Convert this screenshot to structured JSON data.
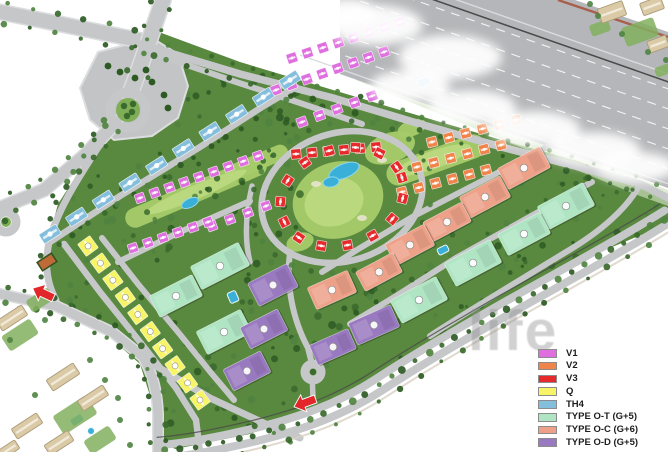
{
  "legend": {
    "items": [
      {
        "label": "V1",
        "color": "#df6fdf"
      },
      {
        "label": "V2",
        "color": "#f0854c"
      },
      {
        "label": "V3",
        "color": "#e62a2c"
      },
      {
        "label": "Q",
        "color": "#f8f468"
      },
      {
        "label": "TH4",
        "color": "#84bedd"
      },
      {
        "label": "TYPE O-T (G+5)",
        "color": "#b0e5c4"
      },
      {
        "label": "TYPE O-C (G+6)",
        "color": "#eda189"
      },
      {
        "label": "TYPE O-D (G+5)",
        "color": "#9979c0"
      }
    ]
  },
  "watermark": {
    "text": "life"
  },
  "map": {
    "colors": {
      "V1": "#df6fdf",
      "V2": "#f0854c",
      "V3": "#e62a2c",
      "Q": "#f8f468",
      "TH4": "#84bedd",
      "OT": "#b0e5c4",
      "OC": "#eda189",
      "OD": "#9979c0",
      "site": "#59883f",
      "golf": "#a6cb69",
      "golfLight": "#bdd97f",
      "sand": "#e8e4cf",
      "road": "#c6c7c9",
      "casing": "#dcdddf",
      "highway": "#b5b6b9",
      "junction": "#c3c4c6",
      "tree1": "#3a6a2d",
      "tree2": "#4f8340",
      "tree3": "#2d5a23",
      "water": "#3ab0d8",
      "waterEdge": "#8fd6ea",
      "beige": "#dbcaa6",
      "beigeEdge": "#ab9a77",
      "lawn": "#83b05e",
      "court": "#c06a38",
      "courtEdge": "#33541f",
      "arrow": "#e2262a",
      "rail": "#4a4a4a",
      "redpath": "#a75f4b",
      "badgeRing": "#8f8f8f",
      "island": "#7fae57"
    },
    "site": "148,28 240,62 333,90 420,116 505,141 575,160 640,186 668,202 668,224 600,252 520,295 430,348 340,400 250,434 175,449 160,440 152,402 140,364 104,332 62,307 48,282 46,248 58,204 80,170 102,146 126,112 140,60",
    "junction": "98,52 152,38 178,54 188,86 178,118 152,136 114,140 90,120 80,88",
    "highway": {
      "poly": "340,0 575,0 668,32 668,188 340,74",
      "slope": 0.35,
      "laneIntercepts": [
        -65,
        -85,
        -105,
        -125,
        -145
      ],
      "edgeIntercepts": [
        -50,
        -160
      ],
      "rail": -152,
      "redpathD": "M558,0 L668,37",
      "verge": "356,80 640,196 668,206 668,190 360,70"
    },
    "roads": [
      {
        "d": "M0,12 L70,26 L148,42",
        "w": 14,
        "t": [
          [
            -10,
            26
          ],
          [
            10,
            26
          ]
        ]
      },
      {
        "d": "M163,0 L150,38 L136,78 L130,94",
        "w": 15,
        "t": [
          [
            -10,
            24
          ],
          [
            10,
            24
          ]
        ]
      },
      {
        "d": "M116,122 L84,156 L44,190 L0,208",
        "w": 12,
        "t": [
          [
            -9,
            18
          ],
          [
            9,
            18
          ]
        ]
      },
      {
        "d": "M113,124 C92,158 62,198 50,238 C44,262 46,282 56,300",
        "w": 7,
        "t": [
          [
            7,
            18
          ]
        ]
      },
      {
        "d": "M140,44 L240,74 L333,98 L420,124 L505,148 L575,166 L640,184 L668,198",
        "w": 7.5,
        "t": [
          [
            -8,
            22
          ],
          [
            7,
            16
          ]
        ]
      },
      {
        "d": "M0,294 L56,306 L112,332 L143,357 C153,374 157,392 158,414 L158,452",
        "w": 9,
        "t": [
          [
            -8,
            16
          ],
          [
            8,
            16
          ]
        ]
      },
      {
        "d": "M146,360 L210,398 L268,425 L300,438",
        "w": 7,
        "t": [
          [
            7,
            20
          ]
        ]
      },
      {
        "d": "M50,242 L120,196 L200,147 L262,107 L296,87",
        "w": 6.5,
        "t": [
          [
            6,
            18
          ]
        ]
      },
      {
        "d": "M64,244 L100,292 L140,342 L176,388 L196,420 L200,452",
        "w": 6.5,
        "t": []
      },
      {
        "d": "M102,238 L138,284 L178,332 L212,374 L234,400",
        "w": 6,
        "t": []
      },
      {
        "d": "M150,52 L230,80 L300,103 L362,124",
        "w": 6,
        "t": []
      },
      {
        "d": "M118,262 L180,232 L250,201",
        "w": 6,
        "t": []
      },
      {
        "d": "M252,186 C246,212 244,238 250,262",
        "w": 5.5,
        "t": []
      },
      {
        "d": "M290,252 C286,284 292,318 308,348 L312,364",
        "w": 6,
        "t": []
      },
      {
        "d": "M560,140 L480,182 L414,216 L360,248 L322,272",
        "w": 6,
        "t": []
      },
      {
        "d": "M592,182 L524,220 L456,258 L396,296 L350,324",
        "w": 6,
        "t": [
          [
            6,
            22
          ]
        ]
      },
      {
        "d": "M640,184 C628,208 600,232 566,252 C520,280 470,310 430,336",
        "w": 6,
        "t": []
      },
      {
        "d": "M312,372 L313,398",
        "w": 5.5,
        "t": []
      }
    ],
    "ringRoad": {
      "cx": 342,
      "cy": 197,
      "rx": 82,
      "ry": 64,
      "rot": -18,
      "w": 6.5
    },
    "ringTrees": {
      "cx": 342,
      "cy": 197,
      "rx": 92,
      "ry": 74,
      "rot": -18,
      "count": 26,
      "r": 2.8
    },
    "avenue": {
      "d": "M668,216 C620,246 560,278 500,312 C455,338 420,358 380,384 C340,410 300,424 250,436 C215,444 185,450 155,452",
      "laneOffset": 6.5,
      "laneW": 8,
      "outerLine": 14.5,
      "innerWalk": -14
    },
    "roundabouts": [
      {
        "x": 128,
        "y": 110,
        "r": 18,
        "green": 12,
        "trees": [
          [
            124,
            106
          ],
          [
            132,
            112
          ],
          [
            127,
            116
          ],
          [
            133,
            104
          ]
        ]
      },
      {
        "x": 6,
        "y": 222,
        "r": 10,
        "green": 5,
        "trees": [
          [
            5,
            221
          ]
        ]
      },
      {
        "x": 313,
        "y": 372,
        "r": 8,
        "green": 3.5,
        "trees": [
          [
            313,
            372
          ]
        ]
      }
    ],
    "junctionTrees": [
      [
        120,
        72
      ],
      [
        135,
        78
      ],
      [
        152,
        82
      ],
      [
        164,
        95
      ],
      [
        168,
        108
      ],
      [
        108,
        66
      ],
      [
        146,
        70
      ]
    ],
    "golf": [
      {
        "e": [
          338,
          200,
          46,
          38,
          -18
        ]
      },
      {
        "e": [
          390,
          148,
          26,
          15,
          -20
        ]
      },
      {
        "r": [
          436,
          160,
          104,
          24,
          -20
        ]
      },
      {
        "r": [
          196,
          192,
          152,
          20,
          -23
        ]
      },
      {
        "r": [
          258,
          162,
          64,
          16,
          -23
        ]
      },
      {
        "e": [
          300,
          242,
          14,
          9,
          -18
        ]
      },
      {
        "e": [
          412,
          128,
          15,
          8,
          -20
        ]
      }
    ],
    "golfLight": [
      {
        "e": [
          334,
          202,
          30,
          24,
          -18
        ]
      },
      {
        "e": [
          433,
          160,
          40,
          9,
          -20
        ]
      },
      {
        "e": [
          196,
          192,
          55,
          7,
          -23
        ]
      }
    ],
    "sand": [
      [
        316,
        184
      ],
      [
        362,
        218
      ],
      [
        382,
        160
      ]
    ],
    "groves": [
      [
        150,
        55,
        200,
        70,
        40
      ],
      [
        60,
        150,
        120,
        100,
        30
      ],
      [
        180,
        130,
        120,
        120,
        30
      ],
      [
        240,
        210,
        170,
        160,
        42
      ],
      [
        60,
        240,
        120,
        140,
        30
      ],
      [
        390,
        140,
        230,
        160,
        42
      ],
      [
        150,
        300,
        180,
        130,
        32
      ],
      [
        420,
        230,
        200,
        120,
        30
      ],
      [
        560,
        160,
        100,
        60,
        20
      ]
    ],
    "villaRows": [
      {
        "type": "V1",
        "from": [
          292,
          58
        ],
        "to": [
          400,
          22
        ],
        "count": 8,
        "size": 10
      },
      {
        "type": "V1",
        "from": [
          276,
          90
        ],
        "to": [
          384,
          52
        ],
        "count": 8,
        "size": 10
      },
      {
        "type": "V1",
        "from": [
          302,
          122
        ],
        "to": [
          372,
          96
        ],
        "count": 5,
        "size": 10
      },
      {
        "type": "V1",
        "from": [
          140,
          198
        ],
        "to": [
          258,
          156
        ],
        "count": 9,
        "size": 9.5
      },
      {
        "type": "V1",
        "from": [
          212,
          226
        ],
        "to": [
          266,
          206
        ],
        "count": 4,
        "size": 9.5
      },
      {
        "type": "V1",
        "from": [
          133,
          248
        ],
        "to": [
          208,
          222
        ],
        "count": 6,
        "size": 9.5
      },
      {
        "type": "V2",
        "from": [
          432,
          142
        ],
        "to": [
          516,
          120
        ],
        "count": 6,
        "size": 10
      },
      {
        "type": "V2",
        "from": [
          417,
          167
        ],
        "to": [
          501,
          145
        ],
        "count": 6,
        "size": 10
      },
      {
        "type": "V2",
        "from": [
          402,
          192
        ],
        "to": [
          486,
          170
        ],
        "count": 6,
        "size": 10
      },
      {
        "type": "V3",
        "from": [
          296,
          154
        ],
        "to": [
          376,
          147
        ],
        "count": 6,
        "size": 10
      },
      {
        "type": "Q",
        "from": [
          88,
          246
        ],
        "to": [
          200,
          400
        ],
        "count": 10,
        "size": 15
      },
      {
        "type": "TH4",
        "from": [
          50,
          234
        ],
        "to": [
          290,
          80
        ],
        "count": 10,
        "size": 20,
        "slab": true
      }
    ],
    "villaArcs": [
      {
        "type": "V3",
        "cx": 342,
        "cy": 197,
        "rx": 63,
        "ry": 48,
        "rot": -18,
        "a0": 0,
        "a1": 346,
        "count": 15,
        "size": 10
      }
    ],
    "blocks": [
      {
        "type": "OT",
        "x": 220,
        "y": 266,
        "w": 54,
        "h": 26,
        "rot": -27
      },
      {
        "type": "OT",
        "x": 176,
        "y": 296,
        "w": 48,
        "h": 24,
        "rot": -27
      },
      {
        "type": "OT",
        "x": 224,
        "y": 332,
        "w": 50,
        "h": 26,
        "rot": -27
      },
      {
        "type": "OT",
        "x": 566,
        "y": 206,
        "w": 52,
        "h": 26,
        "rot": -28
      },
      {
        "type": "OT",
        "x": 524,
        "y": 234,
        "w": 48,
        "h": 24,
        "rot": -28
      },
      {
        "type": "OT",
        "x": 473,
        "y": 263,
        "w": 52,
        "h": 26,
        "rot": -28
      },
      {
        "type": "OT",
        "x": 419,
        "y": 300,
        "w": 52,
        "h": 26,
        "rot": -28
      },
      {
        "type": "OD",
        "x": 273,
        "y": 285,
        "w": 44,
        "h": 26,
        "rot": -27
      },
      {
        "type": "OD",
        "x": 264,
        "y": 329,
        "w": 42,
        "h": 24,
        "rot": -27
      },
      {
        "type": "OD",
        "x": 247,
        "y": 371,
        "w": 42,
        "h": 24,
        "rot": -27
      },
      {
        "type": "OD",
        "x": 374,
        "y": 325,
        "w": 46,
        "h": 24,
        "rot": -24
      },
      {
        "type": "OD",
        "x": 333,
        "y": 347,
        "w": 42,
        "h": 22,
        "rot": -24
      },
      {
        "type": "OC",
        "x": 524,
        "y": 168,
        "w": 48,
        "h": 24,
        "rot": -28
      },
      {
        "type": "OC",
        "x": 485,
        "y": 197,
        "w": 46,
        "h": 24,
        "rot": -28
      },
      {
        "type": "OC",
        "x": 447,
        "y": 222,
        "w": 44,
        "h": 22,
        "rot": -28
      },
      {
        "type": "OC",
        "x": 410,
        "y": 245,
        "w": 44,
        "h": 24,
        "rot": -28
      },
      {
        "type": "OC",
        "x": 379,
        "y": 272,
        "w": 42,
        "h": 22,
        "rot": -28
      },
      {
        "type": "OC",
        "x": 332,
        "y": 290,
        "w": 44,
        "h": 24,
        "rot": -24
      }
    ],
    "pools": [
      [
        424,
        82,
        13,
        8,
        -20
      ],
      [
        443,
        250,
        11,
        7,
        -26
      ],
      [
        233,
        297,
        9,
        11,
        -24
      ],
      [
        77,
        420,
        13,
        8,
        -33
      ]
    ],
    "fountain": [
      91,
      431,
      3.5
    ],
    "ponds": [
      [
        344,
        171,
        16,
        7,
        -22
      ],
      [
        331,
        182,
        8,
        5,
        -10
      ],
      [
        190,
        203,
        9,
        4.5,
        -25
      ]
    ],
    "court": {
      "x": 47,
      "y": 262,
      "w": 17,
      "h": 10,
      "rot": -33
    },
    "neighbors": {
      "blocks": [
        [
          12,
          318,
          30,
          12,
          -33
        ],
        [
          63,
          377,
          32,
          13,
          -33
        ],
        [
          93,
          398,
          30,
          12,
          -33
        ],
        [
          27,
          426,
          30,
          12,
          -33
        ],
        [
          59,
          443,
          28,
          12,
          -33
        ],
        [
          8,
          450,
          22,
          10,
          -33
        ]
      ],
      "lawns": [
        [
          20,
          335,
          34,
          18,
          -33
        ],
        [
          75,
          415,
          40,
          22,
          -33
        ],
        [
          40,
          300,
          26,
          14,
          -33
        ],
        [
          100,
          440,
          30,
          16,
          -33
        ]
      ],
      "trees": [
        [
          45,
          320
        ],
        [
          105,
          380
        ],
        [
          35,
          395
        ],
        [
          120,
          420
        ],
        [
          70,
          300
        ],
        [
          10,
          340
        ],
        [
          130,
          445
        ],
        [
          90,
          360
        ],
        [
          118,
          398
        ]
      ]
    },
    "topRight": {
      "blocks": [
        [
          612,
          12,
          26,
          15,
          -20
        ],
        [
          652,
          6,
          22,
          13,
          -20
        ],
        [
          658,
          44,
          20,
          12,
          -20
        ]
      ],
      "lawns": [
        [
          640,
          32,
          34,
          20,
          -20
        ],
        [
          600,
          28,
          20,
          12,
          -20
        ],
        [
          664,
          70,
          18,
          10,
          -20
        ]
      ],
      "trees": [
        [
          598,
          16
        ],
        [
          622,
          34
        ],
        [
          648,
          52
        ],
        [
          590,
          4
        ],
        [
          666,
          60
        ]
      ]
    },
    "clouds": [
      [
        375,
        25,
        48,
        20
      ],
      [
        450,
        57,
        52,
        22
      ],
      [
        410,
        86,
        40,
        16
      ],
      [
        472,
        107,
        44,
        17
      ],
      [
        534,
        128,
        46,
        17
      ],
      [
        594,
        149,
        46,
        17
      ],
      [
        636,
        167,
        40,
        15
      ],
      [
        348,
        12,
        30,
        14
      ]
    ],
    "arrows": [
      {
        "x": 53,
        "y": 299,
        "rot": 205
      },
      {
        "x": 316,
        "y": 400,
        "rot": 160
      }
    ]
  }
}
